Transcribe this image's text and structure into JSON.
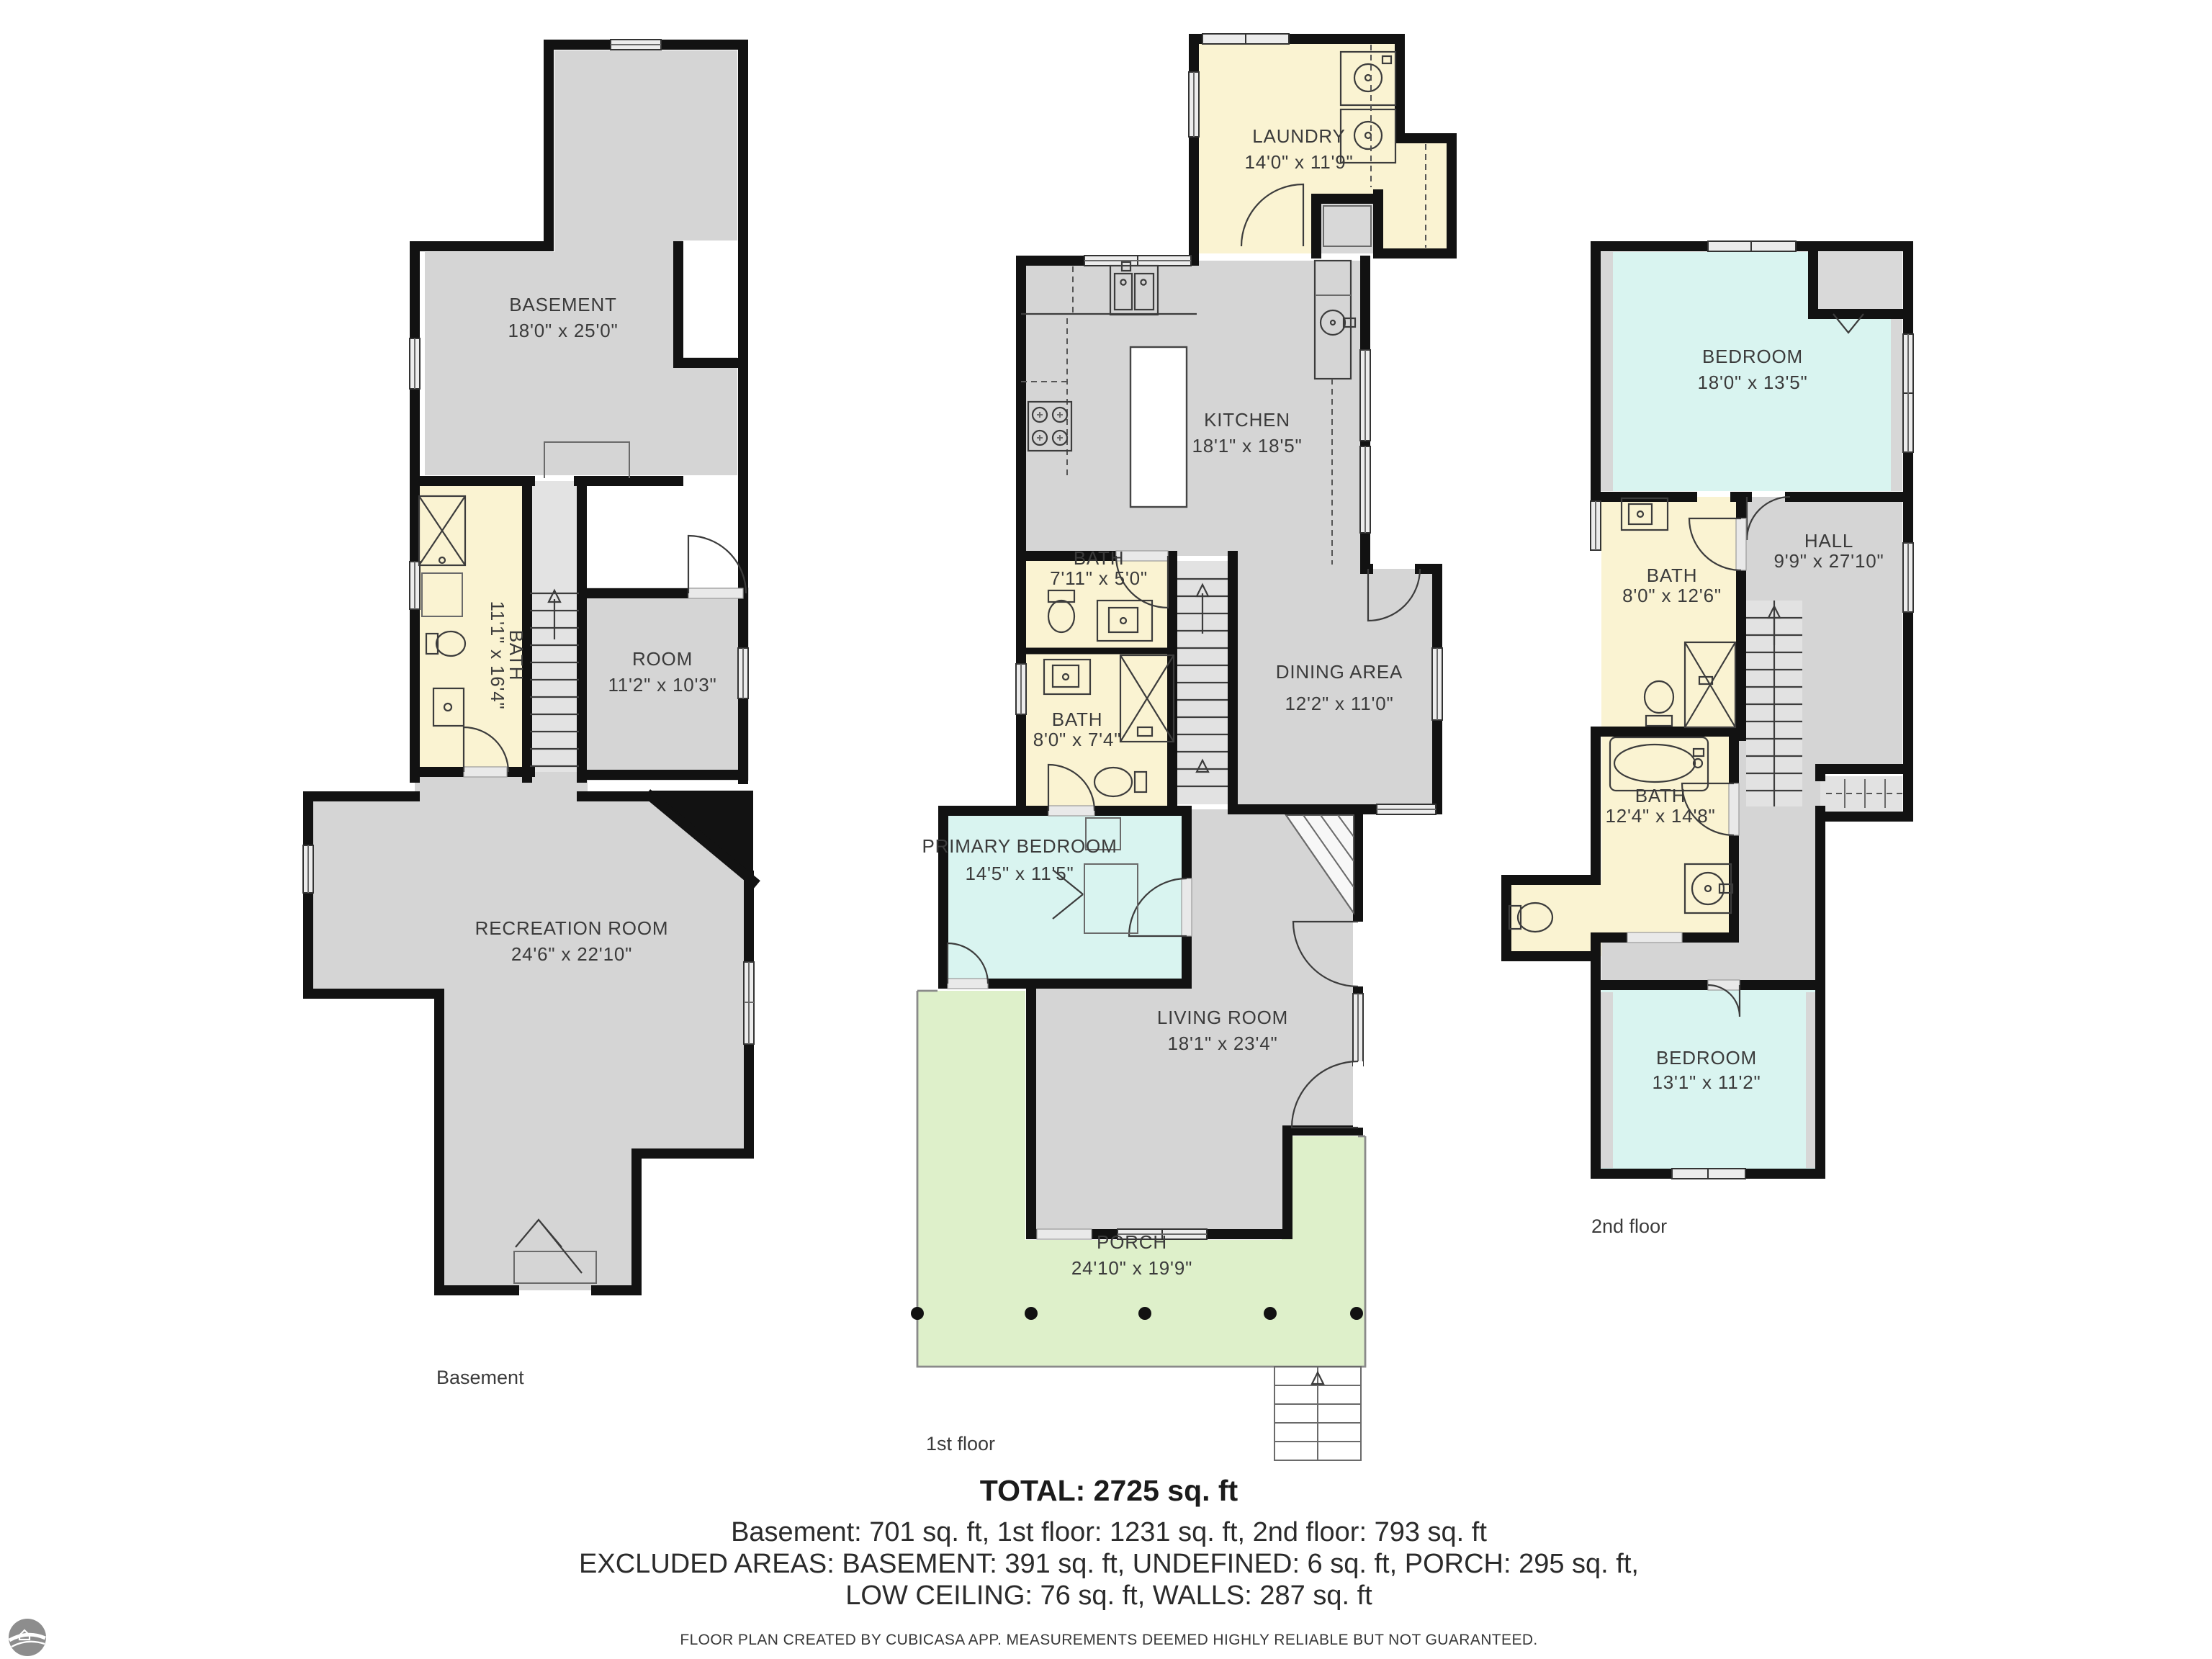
{
  "floors": {
    "basement": {
      "caption": "Basement",
      "rooms": {
        "basement": {
          "name": "BASEMENT",
          "dims": "18'0\" x 25'0\""
        },
        "bath": {
          "name": "BATH",
          "dims": "11'1\" x 16'4\""
        },
        "room": {
          "name": "ROOM",
          "dims": "11'2\" x 10'3\""
        },
        "recreation": {
          "name": "RECREATION ROOM",
          "dims": "24'6\" x 22'10\""
        }
      }
    },
    "first": {
      "caption": "1st floor",
      "rooms": {
        "laundry": {
          "name": "LAUNDRY",
          "dims": "14'0\" x 11'9\""
        },
        "kitchen": {
          "name": "KITCHEN",
          "dims": "18'1\" x 18'5\""
        },
        "bath_small": {
          "name": "BATH",
          "dims": "7'11\" x 5'0\""
        },
        "bath": {
          "name": "BATH",
          "dims": "8'0\" x 7'4\""
        },
        "dining": {
          "name": "DINING AREA",
          "dims": "12'2\" x 11'0\""
        },
        "primary_bedroom": {
          "name": "PRIMARY BEDROOM",
          "dims": "14'5\" x 11'5\""
        },
        "living": {
          "name": "LIVING ROOM",
          "dims": "18'1\" x 23'4\""
        },
        "porch": {
          "name": "PORCH",
          "dims": "24'10\" x 19'9\""
        }
      }
    },
    "second": {
      "caption": "2nd floor",
      "rooms": {
        "bedroom_large": {
          "name": "BEDROOM",
          "dims": "18'0\" x 13'5\""
        },
        "bath_upper": {
          "name": "BATH",
          "dims": "8'0\" x 12'6\""
        },
        "hall": {
          "name": "HALL",
          "dims": "9'9\" x 27'10\""
        },
        "bath_lower": {
          "name": "BATH",
          "dims": "12'4\" x 14'8\""
        },
        "bedroom_small": {
          "name": "BEDROOM",
          "dims": "13'1\" x 11'2\""
        }
      }
    }
  },
  "summary": {
    "total": "TOTAL: 2725 sq. ft",
    "floors_line": "Basement: 701 sq. ft, 1st floor: 1231 sq. ft, 2nd floor: 793 sq. ft",
    "excluded_line1": "EXCLUDED AREAS: BASEMENT: 391 sq. ft, UNDEFINED: 6 sq. ft, PORCH: 295 sq. ft,",
    "excluded_line2": "LOW CEILING: 76 sq. ft, WALLS: 287 sq. ft",
    "disclaimer": "FLOOR PLAN CREATED BY CUBICASA APP. MEASUREMENTS DEEMED HIGHLY RELIABLE BUT NOT GUARANTEED."
  },
  "colors": {
    "wall": "#121212",
    "floor_gray": "#d5d5d5",
    "wet_room_yellow": "#faf3d2",
    "bedroom_cyan": "#d9f4f0",
    "porch_green": "#def0ca"
  }
}
